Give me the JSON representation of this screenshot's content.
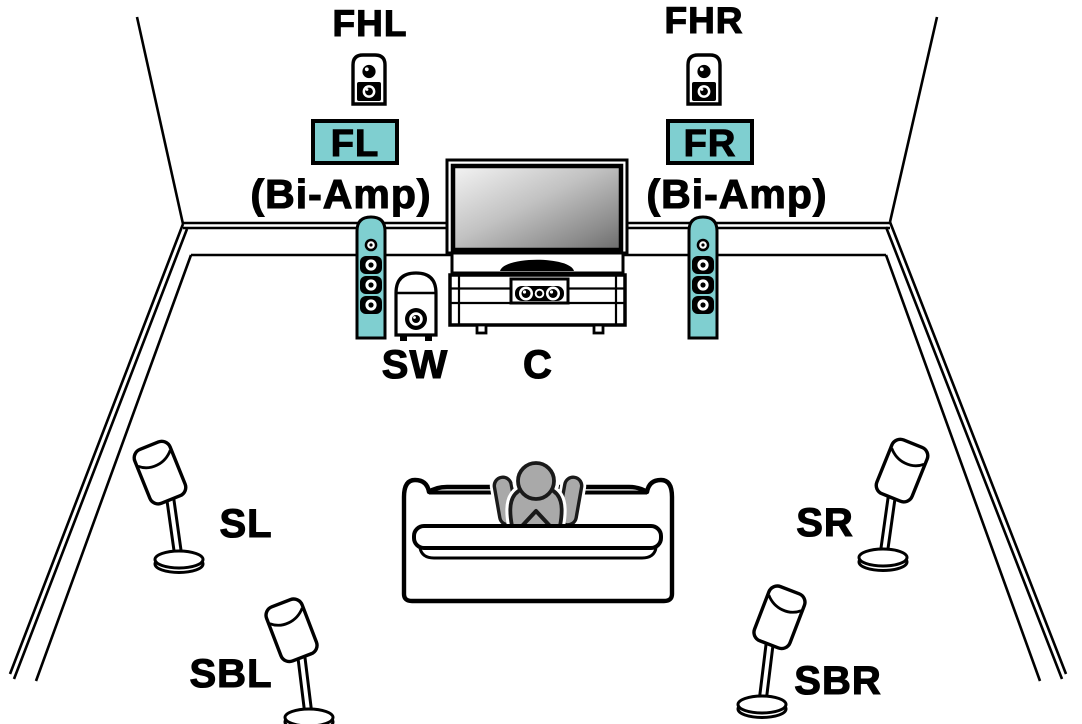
{
  "figure": {
    "type": "speaker-placement-diagram",
    "description": "7.1-channel home theater speaker layout with front height speakers and bi-amped front speakers"
  },
  "colors": {
    "accent": "#7FCFD0",
    "person_fill": "#A9A9A9",
    "person_outline": "#1A1A1A",
    "line": "#000000",
    "background": "#FFFFFF"
  },
  "speakers": {
    "front_height_left": {
      "label": "FHL"
    },
    "front_height_right": {
      "label": "FHR"
    },
    "front_left": {
      "label": "FL",
      "highlighted": true,
      "note": "(Bi-Amp)"
    },
    "front_right": {
      "label": "FR",
      "highlighted": true,
      "note": "(Bi-Amp)"
    },
    "subwoofer": {
      "label": "SW"
    },
    "center": {
      "label": "C"
    },
    "surround_left": {
      "label": "SL"
    },
    "surround_right": {
      "label": "SR"
    },
    "surround_back_left": {
      "label": "SBL"
    },
    "surround_back_right": {
      "label": "SBR"
    }
  }
}
